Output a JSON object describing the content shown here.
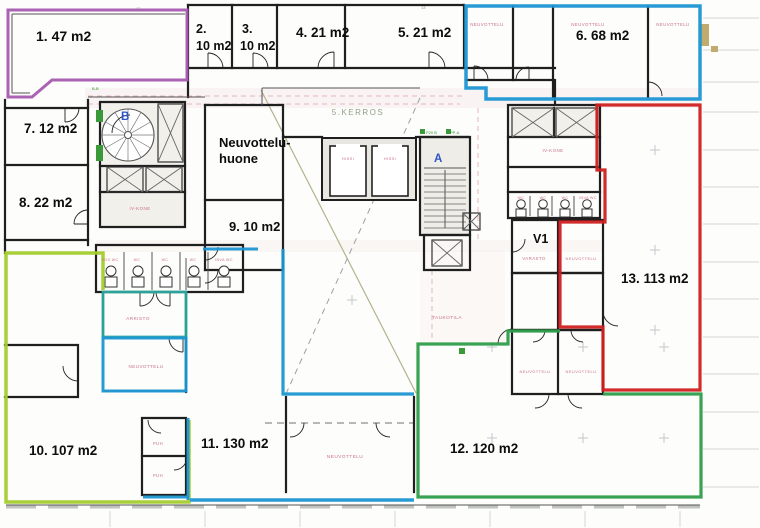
{
  "app": {
    "type": "scanned-floor-plan",
    "floor_label": "5.KERROS"
  },
  "colors": {
    "purple": "#a85ab0",
    "blue": "#1e96d2",
    "teal": "#2ba89f",
    "green": "#2e9e4a",
    "chartreuse": "#a4cc2e",
    "red": "#cf2020",
    "pink": "#c4677e",
    "wall": "#1f1f1f",
    "thinwall": "#555555",
    "blue_letter": "#2f55c4",
    "kerros_text": "#93a088",
    "tiny_green": "#2e8f2e",
    "tiny_gray": "#8a8a8a",
    "rule_gray": "#d4d7da",
    "dash_pink": "#e2a9b4",
    "olive": "#b5b28e",
    "dash_gray": "#9aa0a0",
    "tan": "#c2ab6e",
    "wash_pink": "#f2dede"
  },
  "area_labels": [
    {
      "id": "area-1",
      "text": "1. 47 m2",
      "x": 36,
      "y": 41,
      "size": 14
    },
    {
      "id": "area-2a",
      "text": "2.",
      "x": 196,
      "y": 33,
      "size": 12.5
    },
    {
      "id": "area-2b",
      "text": "10 m2",
      "x": 196,
      "y": 50,
      "size": 12.5
    },
    {
      "id": "area-3a",
      "text": "3.",
      "x": 242,
      "y": 33,
      "size": 12.5
    },
    {
      "id": "area-3b",
      "text": "10 m2",
      "x": 240,
      "y": 50,
      "size": 12.5
    },
    {
      "id": "area-4",
      "text": "4. 21 m2",
      "x": 296,
      "y": 37,
      "size": 13.5
    },
    {
      "id": "area-5",
      "text": "5. 21 m2",
      "x": 398,
      "y": 37,
      "size": 13.5
    },
    {
      "id": "area-6",
      "text": "6. 68 m2",
      "x": 576,
      "y": 40,
      "size": 13.5
    },
    {
      "id": "area-7",
      "text": "7. 12 m2",
      "x": 24,
      "y": 133,
      "size": 13.5
    },
    {
      "id": "meeting-room-line1",
      "text": "Neuvottelu-",
      "x": 219,
      "y": 147,
      "size": 13
    },
    {
      "id": "meeting-room-line2",
      "text": "huone",
      "x": 219,
      "y": 163,
      "size": 13
    },
    {
      "id": "area-8",
      "text": "8. 22 m2",
      "x": 19,
      "y": 207,
      "size": 13.5
    },
    {
      "id": "area-9",
      "text": "9. 10 m2",
      "x": 229,
      "y": 231,
      "size": 13
    },
    {
      "id": "room-v1",
      "text": "V1",
      "x": 533,
      "y": 243,
      "size": 12.5
    },
    {
      "id": "area-13",
      "text": "13. 113 m2",
      "x": 621,
      "y": 283,
      "size": 13.5
    },
    {
      "id": "area-10",
      "text": "10. 107 m2",
      "x": 29,
      "y": 455,
      "size": 13.5
    },
    {
      "id": "area-11",
      "text": "11. 130 m2",
      "x": 201,
      "y": 448,
      "size": 13.5
    },
    {
      "id": "area-12",
      "text": "12. 120 m2",
      "x": 450,
      "y": 453,
      "size": 13.5
    }
  ],
  "room_labels": [
    {
      "text": "NEUVOTTELU",
      "x": 487,
      "y": 26,
      "size": 4.4
    },
    {
      "text": "NEUVOTTELU",
      "x": 588,
      "y": 26,
      "size": 4.4
    },
    {
      "text": "NEUVOTTELU",
      "x": 673,
      "y": 26,
      "size": 4.4
    },
    {
      "text": "HISSI",
      "x": 348,
      "y": 160,
      "size": 4
    },
    {
      "text": "HISSI",
      "x": 390,
      "y": 160,
      "size": 4
    },
    {
      "text": "IV-KONE",
      "x": 140,
      "y": 210,
      "size": 4.5
    },
    {
      "text": "IV-KONE",
      "x": 553,
      "y": 152,
      "size": 4.5
    },
    {
      "text": "SOS.WC",
      "x": 110,
      "y": 261,
      "size": 3.6
    },
    {
      "text": "WC",
      "x": 137,
      "y": 261,
      "size": 3.6
    },
    {
      "text": "WC",
      "x": 165,
      "y": 261,
      "size": 3.6
    },
    {
      "text": "WC",
      "x": 193,
      "y": 261,
      "size": 3.6
    },
    {
      "text": "INVA WC",
      "x": 224,
      "y": 261,
      "size": 3.6
    },
    {
      "text": "WC",
      "x": 521,
      "y": 199,
      "size": 3.6
    },
    {
      "text": "WC",
      "x": 543,
      "y": 199,
      "size": 3.6
    },
    {
      "text": "WC",
      "x": 565,
      "y": 199,
      "size": 3.6
    },
    {
      "text": "INVA WC",
      "x": 588,
      "y": 199,
      "size": 3.6
    },
    {
      "text": "VARASTO",
      "x": 534,
      "y": 260,
      "size": 4.4
    },
    {
      "text": "NEUVOTTELU",
      "x": 581,
      "y": 260,
      "size": 4
    },
    {
      "text": "ARKISTO",
      "x": 138,
      "y": 320,
      "size": 4.8
    },
    {
      "text": "NEUVOTTELU",
      "x": 146,
      "y": 368,
      "size": 4.6
    },
    {
      "text": "TAUKOTILA",
      "x": 447,
      "y": 319,
      "size": 4.8
    },
    {
      "text": "NEUVOTTELU",
      "x": 535,
      "y": 373,
      "size": 4
    },
    {
      "text": "NEUVOTTELU",
      "x": 581,
      "y": 373,
      "size": 4
    },
    {
      "text": "NEUVOTTELU",
      "x": 345,
      "y": 458,
      "size": 4.8
    },
    {
      "text": "PUH",
      "x": 158,
      "y": 445,
      "size": 4.2
    },
    {
      "text": "PUH",
      "x": 158,
      "y": 477,
      "size": 4.2
    }
  ],
  "stair_letters": [
    {
      "id": "stair-letter-b",
      "text": "B",
      "x": 121,
      "y": 120
    },
    {
      "id": "stair-letter-a",
      "text": "A",
      "x": 434,
      "y": 162
    }
  ],
  "floor_text": {
    "text": "5.KERROS",
    "x": 358,
    "y": 115,
    "size": 8
  },
  "tiny_labels": {
    "green": [
      {
        "text": "P20 B",
        "x": 426,
        "y": 134
      },
      {
        "text": "PP-A",
        "x": 450,
        "y": 134
      },
      {
        "text": "B-B",
        "x": 92,
        "y": 90
      }
    ],
    "gray": [
      {
        "text": "13",
        "x": 136,
        "y": 10
      },
      {
        "text": "13",
        "x": 421,
        "y": 9
      }
    ]
  },
  "plan": {
    "zones": [
      {
        "id": "zone-1-outline",
        "color": "purple",
        "width": 3,
        "path": "M8,10 H187 V80 H52 L32,97 H8 Z"
      },
      {
        "id": "zone-6-outline",
        "color": "blue",
        "width": 3.5,
        "path": "M466,6 H700 V99 H486 V88 H466 Z"
      },
      {
        "id": "zone-13-outline",
        "color": "red",
        "width": 3.2,
        "path": "M597,105 V170 H605 V222 H560 V327 H603 V390 H700 V105 Z"
      },
      {
        "id": "zone-12-outline",
        "color": "green",
        "width": 3.2,
        "path": "M560,331 H508 V344 H418 V497 H701 V394 H603"
      },
      {
        "id": "zone-10-outline",
        "color": "chartreuse",
        "width": 3.5,
        "path": "M103,290 V253 H6 V502 H189 V420"
      },
      {
        "id": "zone-arkisto-outline",
        "color": "teal",
        "width": 2.8,
        "path": "M103,292 H186 V337 H103 Z"
      },
      {
        "id": "zone-11-room-outline",
        "color": "blue",
        "width": 3,
        "path": "M103,338 H186 V391 H103 Z"
      },
      {
        "id": "zone-11-top-segment",
        "color": "blue",
        "width": 3,
        "path": "M203,249 H258"
      },
      {
        "id": "zone-11-main-outline",
        "color": "blue",
        "width": 3.2,
        "path": "M283,249 V394 H414"
      },
      {
        "id": "zone-11-bottom-edge",
        "color": "blue",
        "width": 3.5,
        "path": "M190,500 H414"
      },
      {
        "id": "zone-11-puh-edge",
        "color": "blue",
        "width": 3,
        "path": "M188,418 V500"
      },
      {
        "id": "zone-11-puh-bottom",
        "color": "blue",
        "width": 3,
        "path": "M143,497 H188"
      }
    ],
    "walls": [
      "M188,5 H464",
      "M188,5 V97",
      "M232,5 V68",
      "M277,5 V68",
      "M345,5 V68",
      "M464,5 V68",
      "M188,68 H555",
      "M513,6 V80",
      "M553,6 V97",
      "M466,80 H553",
      "M648,6 V97",
      "M555,80 V105",
      "M5,108 H88",
      "M5,165 H88",
      "M5,240 H88",
      "M88,100 V245",
      "M5,100 V253",
      "M100,102 H185 V227 H100 Z",
      "M100,166 H185",
      "M100,192 H185",
      "M96,245 H243 V292 H96 Z",
      "M5,345 H78 V397 H5",
      "M103,292 V337",
      "M186,292 V392",
      "M142,418 H186 V495 H142 Z",
      "M142,456 H186",
      "M286,397 V492",
      "M414,397 V492",
      "M205,105 V270",
      "M283,105 V270",
      "M205,105 H283",
      "M205,200 H283",
      "M205,270 H283",
      "M283,137 H322",
      "M416,137 H468",
      "M420,137 H470 V235 H420 Z",
      "M424,235 H470 V270 H424 Z",
      "M508,105 H600 V218 H508 Z",
      "M508,137 H600",
      "M554,108 V137",
      "M508,167 H600",
      "M508,192 H600",
      "M512,220 H603 V273 H512 Z",
      "M558,220 V273",
      "M512,273 H603 V330 H512 Z",
      "M558,273 V330",
      "M512,330 H603 V394 H512 Z",
      "M558,330 V394"
    ],
    "thin_walls": [
      "M124,252 V290",
      "M152,252 V290",
      "M180,252 V290",
      "M208,252 V290",
      "M530,196 V216",
      "M552,196 V216",
      "M574,196 V216",
      "M103,292 H186",
      "M103,337 H186",
      "M103,391 H186",
      "M12,14 H185",
      "M12,14 V93",
      "M12,93 H30",
      "M262,88 H420",
      "M262,88 V105",
      "M88,97 H205",
      "M6,505 H700",
      "M186,258 V290",
      "M424,168 H466",
      "M445,170 V228"
    ],
    "doors": [
      "M223,68 A15,15 0 0 0 208,53 M208,68 V53",
      "M268,68 A15,15 0 0 0 253,53 M253,68 V53",
      "M318,68 A16,16 0 0 1 334,52 M334,68 V52",
      "M445,68 A16,16 0 0 0 429,52 M429,68 V52",
      "M488,80 A14,14 0 0 0 474,66 M474,80 V66",
      "M516,80 A13,13 0 0 1 529,67 M529,80 V67",
      "M648,82 A14,14 0 0 1 662,96",
      "M79,108 A14,14 0 0 1 65,122 M65,108 V122",
      "M88,210 A14,14 0 0 0 74,224 M88,224 H74",
      "M205,260 A13,13 0 0 0 218,247",
      "M205,283 A13,13 0 0 0 218,270",
      "M154,292 A14,14 0 0 1 140,306 M140,292 V306",
      "M156,292 A14,14 0 0 0 170,306 M170,292 V306",
      "M169,338 A14,14 0 0 0 183,352 M183,338 V352",
      "M78,381 A15,15 0 0 1 63,366",
      "M512,252 A13,13 0 0 0 525,239",
      "M545,330 A12,12 0 0 1 533,342",
      "M571,330 A12,12 0 0 0 583,342",
      "M549,394 A14,14 0 0 1 535,408",
      "M568,394 A14,14 0 0 0 582,408",
      "M603,311 A15,15 0 0 0 618,326",
      "M498,344 A15,15 0 0 1 513,329",
      "M304,423 A14,14 0 0 1 290,437",
      "M376,423 A14,14 0 0 0 390,437",
      "M148,420 A13,13 0 0 0 161,433",
      "M187,457 A13,13 0 0 1 174,470",
      "M112,133 A18,18 0 0 1 130,115"
    ],
    "fills": [
      {
        "x": 100,
        "y": 102,
        "w": 85,
        "h": 125,
        "f": "#f2f0ea"
      },
      {
        "x": 322,
        "y": 138,
        "w": 94,
        "h": 62,
        "f": "#e9e7e1"
      },
      {
        "x": 420,
        "y": 137,
        "w": 50,
        "h": 98,
        "f": "#efede8"
      },
      {
        "x": 508,
        "y": 105,
        "w": 92,
        "h": 32,
        "f": "#f2f0ea"
      }
    ],
    "washes": [
      {
        "x": 85,
        "y": 88,
        "w": 615,
        "h": 20,
        "o": 0.28
      },
      {
        "x": 96,
        "y": 240,
        "w": 505,
        "h": 12,
        "o": 0.2
      },
      {
        "x": 420,
        "y": 250,
        "w": 85,
        "h": 95,
        "o": 0.15
      }
    ],
    "xbraces": [
      [
        158,
        104,
        25,
        58
      ],
      [
        107,
        167,
        36,
        25
      ],
      [
        146,
        167,
        36,
        25
      ],
      [
        512,
        108,
        42,
        29
      ],
      [
        556,
        108,
        41,
        29
      ],
      [
        432,
        240,
        30,
        26
      ],
      [
        463,
        213,
        17,
        17
      ]
    ],
    "elevator": {
      "shaft": {
        "x": 322,
        "y": 138,
        "w": 94,
        "h": 62
      },
      "cars": [
        {
          "x": 330,
          "y": 146,
          "w": 36,
          "h": 50
        },
        {
          "x": 372,
          "y": 146,
          "w": 36,
          "h": 50
        }
      ],
      "gaps": [
        {
          "x": 336,
          "y": 144,
          "w": 24,
          "h": 3.5
        },
        {
          "x": 378,
          "y": 144,
          "w": 24,
          "h": 3.5
        }
      ]
    },
    "stair_treads": {
      "x1": 424,
      "x2": 466,
      "y1": 174,
      "y2": 228,
      "step": 6
    },
    "spiral": {
      "cx": 128,
      "cy": 135,
      "r": 26,
      "spokes": 12
    },
    "wc": {
      "left": {
        "cx": [
          111,
          138,
          166,
          194,
          224
        ],
        "cy": 271,
        "r": 5,
        "tank_y": 277,
        "tank_h": 10,
        "tank_w": 12
      },
      "right": {
        "cx": [
          521,
          543,
          565,
          587
        ],
        "cy": 204,
        "r": 4.3,
        "tank_y": 209,
        "tank_h": 8,
        "tank_w": 10
      }
    },
    "diagonals": {
      "solid": "M261,90 L416,393",
      "dashed": "M420,98 L285,396"
    },
    "partition_dashed": "M265,423 H413",
    "dashed_pink": [
      "M88,96 H462",
      "M88,104 H460",
      "M478,108 V240",
      "M432,252 V342"
    ],
    "crosses": [
      [
        492,
        347
      ],
      [
        583,
        347
      ],
      [
        664,
        347
      ],
      [
        492,
        438
      ],
      [
        583,
        438
      ],
      [
        664,
        438
      ],
      [
        352,
        300
      ],
      [
        655,
        150
      ],
      [
        655,
        250
      ],
      [
        655,
        330
      ]
    ],
    "margin_rules": {
      "x1": 703,
      "x2": 759,
      "ys": [
        18,
        50,
        82,
        112,
        150,
        187,
        224,
        262,
        299,
        337,
        374,
        412,
        449,
        487
      ]
    },
    "bottom_ticks": {
      "y1": 511,
      "y2": 527,
      "xs": [
        110,
        205,
        300,
        395,
        490,
        585,
        680
      ]
    },
    "bottom_dash": "M6,507 H700",
    "green_bits": [
      [
        96,
        110,
        7,
        12
      ],
      [
        96,
        145,
        7,
        16
      ],
      [
        420,
        129,
        5,
        5
      ],
      [
        446,
        129,
        5,
        5
      ],
      [
        459,
        348,
        6,
        6
      ]
    ],
    "tan_bits": [
      [
        700,
        24,
        9,
        22
      ],
      [
        711,
        46,
        7,
        6
      ]
    ]
  }
}
